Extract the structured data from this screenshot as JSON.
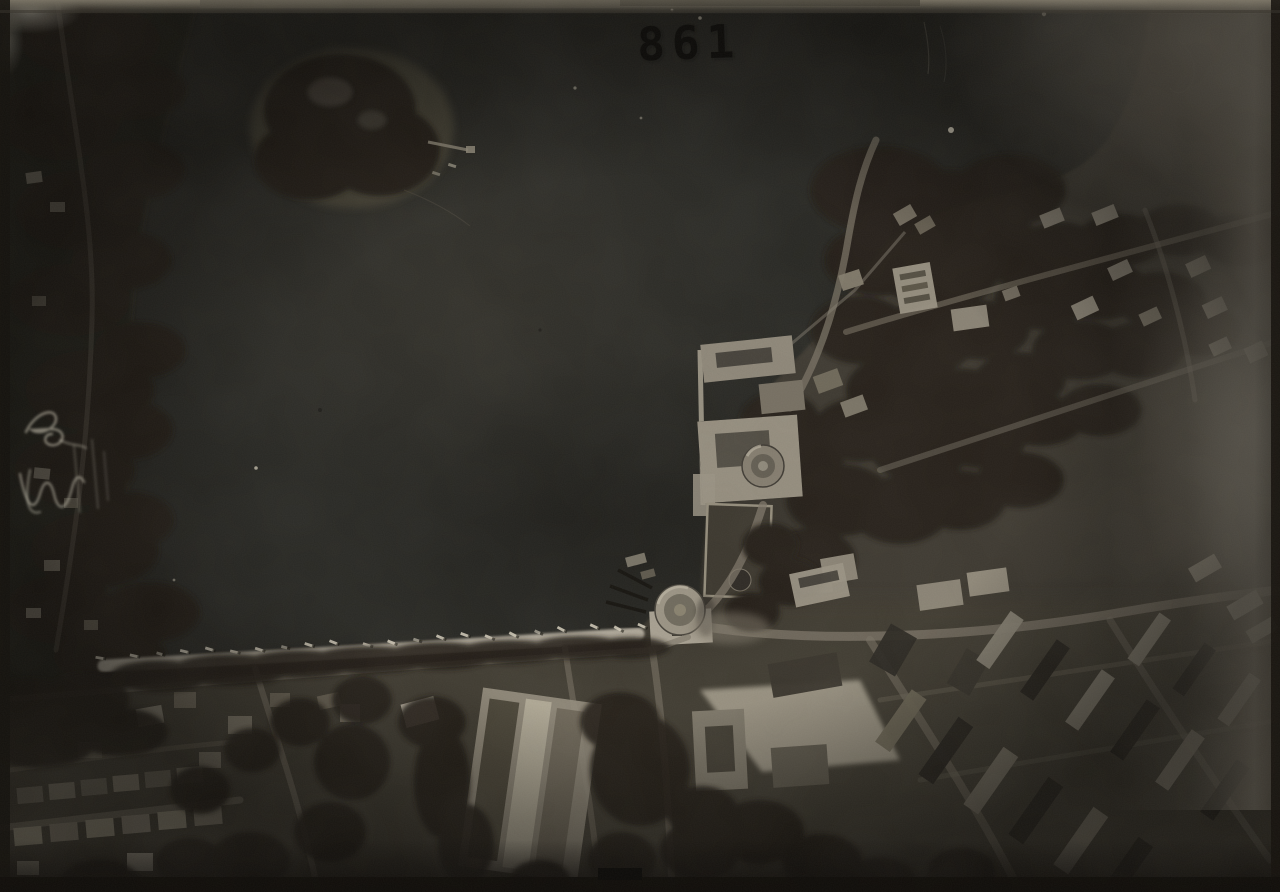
{
  "photo": {
    "stamp": {
      "number": "861"
    },
    "handwriting": {
      "mark1": "es",
      "mark2": "W"
    },
    "boats": {
      "count": 22
    },
    "palette": {
      "paper_border": "#14110d",
      "water": "#282623",
      "trees": "#201d17",
      "town": "#3c3830",
      "beach": "#b6afa0",
      "buildings": "#958e7f",
      "haze": "#a29a89",
      "stamp_ink": "#0b0a08",
      "handwriting_ink": "#d8d1c0"
    }
  }
}
